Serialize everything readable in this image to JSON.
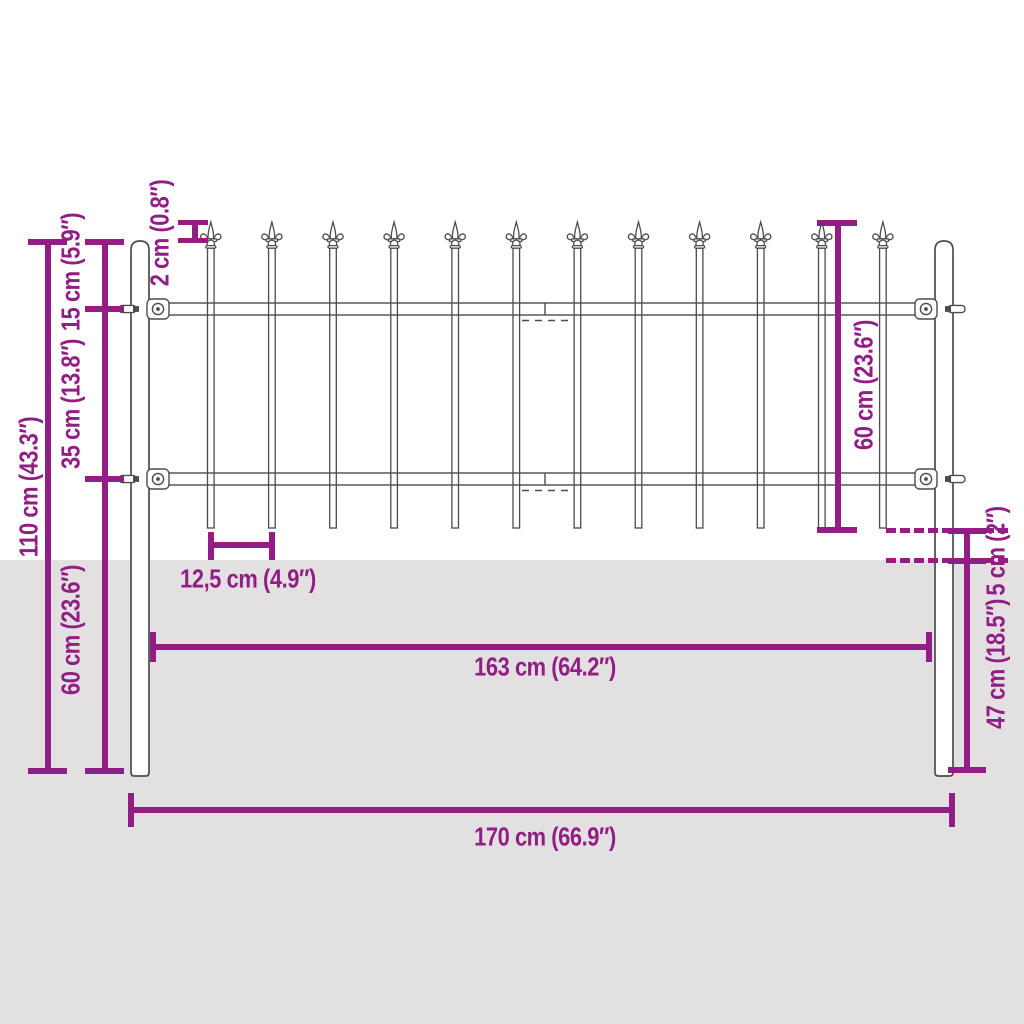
{
  "diagram": {
    "type": "product-dimension-diagram",
    "subject": "steel garden fence panel with spear-top pickets and round posts",
    "colors": {
      "dimension_accent": "#911d85",
      "ground": "#e2e0e1",
      "outline": "#4c4c4c",
      "background": "#ffffff"
    },
    "fence": {
      "picket_count": 12,
      "rail_count": 2,
      "post_count": 2
    },
    "labels": {
      "total_height": "110 cm (43.3″)",
      "post_top_to_top_rail": "15 cm (5.9″)",
      "rail_to_rail": "35 cm (13.8″)",
      "bottom_rail_to_post_bottom": "60 cm (23.6″)",
      "spike_above_post": "2 cm (0.8″)",
      "picket_spacing": "12,5 cm (4.9″)",
      "panel_height": "60 cm (23.6″)",
      "picket_to_ground_gap": "5 cm (2″)",
      "post_below_ground": "47 cm (18.5″)",
      "panel_width": "163 cm (64.2″)",
      "total_width": "170 cm (66.9″)"
    }
  }
}
